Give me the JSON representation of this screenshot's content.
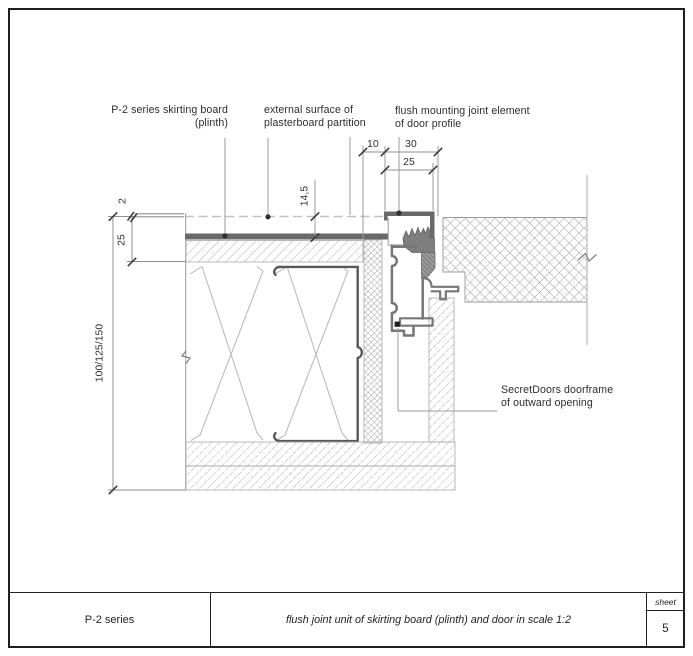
{
  "colors": {
    "border": "#222222",
    "line_gray": "#999999",
    "profile_gray": "#767676",
    "fill_dark_gray": "#696969",
    "hatch_gray": "#b3b3b3",
    "text": "#2d2d2d"
  },
  "annotations": {
    "skirting_label": {
      "line1": "P-2 series skirting board",
      "line2": "(plinth)"
    },
    "surface_label": {
      "line1": "external surface of",
      "line2": "plasterboard partition"
    },
    "joint_label": {
      "line1": "flush mounting joint element",
      "line2": "of door profile"
    },
    "doorframe_label": {
      "line1": "SecretDoors doorframe",
      "line2": "of outward opening"
    }
  },
  "dimensions": {
    "strip_width": "10",
    "frame_outer": "30",
    "frame_inner": "25",
    "surface_offset": "14,5",
    "proud_edge": "2",
    "skirting_depth": "25",
    "plinth_heights": "100/125/150"
  },
  "title_block": {
    "series": "P-2 series",
    "title": "flush joint unit of skirting board (plinth) and door in scale 1:2",
    "sheet_label": "sheet",
    "sheet_number": "5"
  }
}
